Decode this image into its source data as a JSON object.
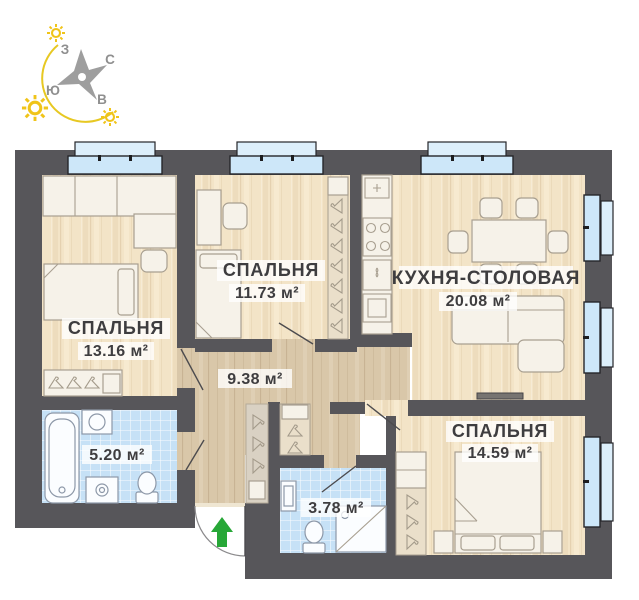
{
  "compass": {
    "west": "З",
    "north": "С",
    "south": "Ю",
    "east": "В"
  },
  "rooms": [
    {
      "id": "bedroom-1",
      "name": "СПАЛЬНЯ",
      "area": "13.16 м²"
    },
    {
      "id": "bedroom-2",
      "name": "СПАЛЬНЯ",
      "area": "11.73 м²"
    },
    {
      "id": "kitchen-dining",
      "name": "КУХНЯ-СТОЛОВАЯ",
      "area": "20.08 м²"
    },
    {
      "id": "hallway",
      "name": "",
      "area": "9.38 м²"
    },
    {
      "id": "bathroom",
      "name": "",
      "area": "5.20 м²"
    },
    {
      "id": "wc",
      "name": "",
      "area": "3.78 м²"
    },
    {
      "id": "bedroom-3",
      "name": "СПАЛЬНЯ",
      "area": "14.59 м²"
    }
  ],
  "icons": {
    "entry_arrow": "up-arrow",
    "compass_star": "4-point-star",
    "sun": "sun-rays",
    "hanger": "clothes-hanger"
  },
  "colors": {
    "wall": "#57565a",
    "floor": "#f3e4c7",
    "hallway_floor": "#d9c7a9",
    "closet": "#eadfca",
    "tile": "#c6e1f6",
    "window_glass": "#cde7f9",
    "window_sill": "#ddeffb",
    "furniture_outline": "#a89f90",
    "entry_arrow": "#27a737",
    "sun": "#f0c419",
    "compass_star": "#9e9e9e",
    "label_text": "#3e3d3f"
  }
}
